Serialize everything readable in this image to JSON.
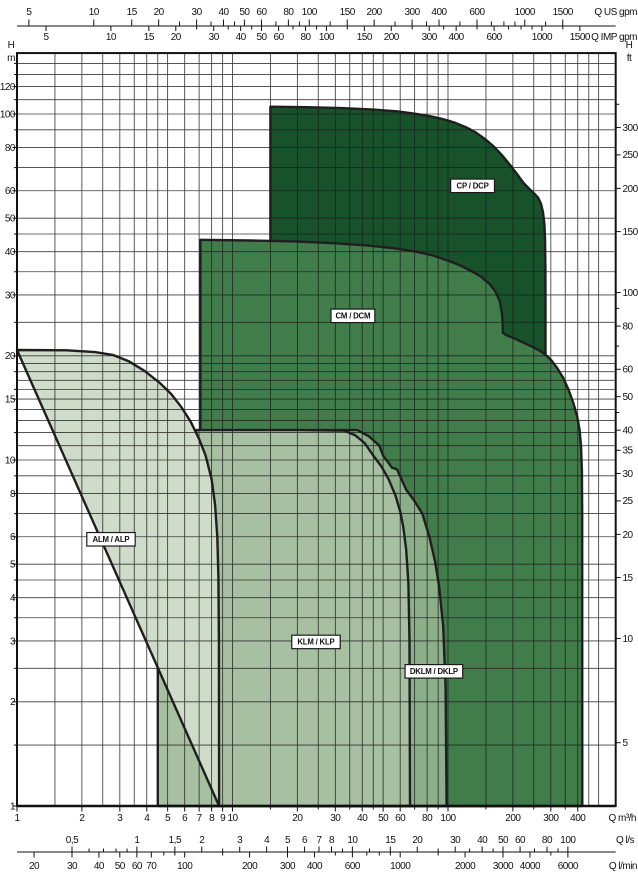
{
  "chart_data": {
    "type": "area",
    "title": "",
    "scale": {
      "x_type": "log",
      "y_type": "log",
      "q_min": 1,
      "q_max": 600,
      "q_unit": "m3/h",
      "h_min": 1,
      "h_max": 150,
      "h_unit": "m",
      "grid": "on"
    },
    "outline_color": "#1f1f1f",
    "grid_color": "#1c1c1c",
    "frame_color": "#111111",
    "x_axes": [
      {
        "id": "us-gpm",
        "unit_label": "Q US gpm",
        "factor_to_m3h": 0.22712,
        "row": "top1",
        "ticks": [
          [
            5,
            "5"
          ],
          [
            10,
            "10"
          ],
          [
            15,
            "15"
          ],
          [
            20,
            "20"
          ],
          [
            30,
            "30"
          ],
          [
            40,
            "40"
          ],
          [
            50,
            "50"
          ],
          [
            60,
            "60"
          ],
          [
            80,
            "80"
          ],
          [
            100,
            "100"
          ],
          [
            150,
            "150"
          ],
          [
            200,
            "200"
          ],
          [
            300,
            "300"
          ],
          [
            400,
            "400"
          ],
          [
            600,
            "600"
          ],
          [
            1000,
            "1000"
          ],
          [
            1500,
            "1500"
          ]
        ],
        "minor": [
          25,
          35,
          45,
          70,
          90,
          125,
          250,
          350,
          500,
          700,
          800,
          900,
          1250
        ]
      },
      {
        "id": "imp-gpm",
        "unit_label": "Q IMP gpm",
        "factor_to_m3h": 0.27276,
        "row": "top2",
        "ticks": [
          [
            5,
            "5"
          ],
          [
            10,
            "10"
          ],
          [
            15,
            "15"
          ],
          [
            20,
            "20"
          ],
          [
            30,
            "30"
          ],
          [
            40,
            "40"
          ],
          [
            50,
            "50"
          ],
          [
            60,
            "60"
          ],
          [
            80,
            "80"
          ],
          [
            100,
            "100"
          ],
          [
            150,
            "150"
          ],
          [
            200,
            "200"
          ],
          [
            300,
            "300"
          ],
          [
            400,
            "400"
          ],
          [
            600,
            "600"
          ],
          [
            1000,
            "1000"
          ],
          [
            1500,
            "1500"
          ]
        ],
        "minor": [
          25,
          35,
          45,
          70,
          90,
          125,
          250,
          350,
          500,
          700,
          800,
          900,
          1250
        ]
      },
      {
        "id": "m3h",
        "unit_label": "Q m³/h",
        "factor_to_m3h": 1,
        "row": "bottom1",
        "ticks": [
          [
            1,
            "1"
          ],
          [
            2,
            "2"
          ],
          [
            3,
            "3"
          ],
          [
            4,
            "4"
          ],
          [
            5,
            "5"
          ],
          [
            6,
            "6"
          ],
          [
            7,
            "7"
          ],
          [
            8,
            "8"
          ],
          [
            9,
            "9"
          ],
          [
            10,
            "10"
          ],
          [
            20,
            "20"
          ],
          [
            30,
            "30"
          ],
          [
            40,
            "40"
          ],
          [
            50,
            "50"
          ],
          [
            60,
            "60"
          ],
          [
            80,
            "80"
          ],
          [
            100,
            "100"
          ],
          [
            200,
            "200"
          ],
          [
            300,
            "300"
          ],
          [
            400,
            "400"
          ]
        ],
        "minor": [
          15,
          25,
          35,
          45,
          70,
          90,
          150,
          250,
          350
        ]
      },
      {
        "id": "ls",
        "unit_label": "Q l/s",
        "factor_to_m3h": 3.6,
        "row": "bottom2-above",
        "ticks": [
          [
            0.5,
            "0,5"
          ],
          [
            1,
            "1"
          ],
          [
            1.5,
            "1,5"
          ],
          [
            2,
            "2"
          ],
          [
            3,
            "3"
          ],
          [
            4,
            "4"
          ],
          [
            5,
            "5"
          ],
          [
            6,
            "6"
          ],
          [
            7,
            "7"
          ],
          [
            8,
            "8"
          ],
          [
            10,
            "10"
          ],
          [
            15,
            "15"
          ],
          [
            20,
            "20"
          ],
          [
            30,
            "30"
          ],
          [
            40,
            "40"
          ],
          [
            50,
            "50"
          ],
          [
            60,
            "60"
          ],
          [
            80,
            "80"
          ],
          [
            100,
            "100"
          ]
        ],
        "minor": [
          0.6,
          0.7,
          0.8,
          0.9,
          2.5,
          9,
          12,
          25,
          35,
          45,
          70,
          90
        ]
      },
      {
        "id": "lmin",
        "unit_label": "Q l/min",
        "factor_to_m3h": 0.06,
        "row": "bottom2-below",
        "ticks": [
          [
            20,
            "20"
          ],
          [
            30,
            "30"
          ],
          [
            40,
            "40"
          ],
          [
            50,
            "50"
          ],
          [
            60,
            "60"
          ],
          [
            70,
            "70"
          ],
          [
            100,
            "100"
          ],
          [
            200,
            "200"
          ],
          [
            300,
            "300"
          ],
          [
            400,
            "400"
          ],
          [
            600,
            "600"
          ],
          [
            1000,
            "1000"
          ],
          [
            2000,
            "2000"
          ],
          [
            3000,
            "3000"
          ],
          [
            4000,
            "4000"
          ],
          [
            6000,
            "6000"
          ]
        ],
        "minor": [
          80,
          90,
          150,
          500,
          700,
          800,
          900,
          1500,
          5000
        ]
      }
    ],
    "y_axes": [
      {
        "id": "h-m",
        "head": [
          "H",
          "m"
        ],
        "factor_to_m": 1,
        "side": "left",
        "ticks": [
          [
            1,
            "1"
          ],
          [
            2,
            "2"
          ],
          [
            3,
            "3"
          ],
          [
            4,
            "4"
          ],
          [
            5,
            "5"
          ],
          [
            6,
            "6"
          ],
          [
            8,
            "8"
          ],
          [
            10,
            "10"
          ],
          [
            15,
            "15"
          ],
          [
            20,
            "20"
          ],
          [
            30,
            "30"
          ],
          [
            40,
            "40"
          ],
          [
            50,
            "50"
          ],
          [
            60,
            "60"
          ],
          [
            80,
            "80"
          ],
          [
            100,
            "100"
          ],
          [
            120,
            "120"
          ]
        ],
        "minor": [
          1.5,
          2.5,
          3.5,
          4.5,
          7,
          9,
          12,
          14,
          16,
          18,
          25,
          35,
          45,
          70,
          90,
          110,
          130,
          140
        ]
      },
      {
        "id": "h-ft",
        "head": [
          "H",
          "ft"
        ],
        "factor_to_m": 0.3048,
        "side": "right",
        "ticks": [
          [
            5,
            "5"
          ],
          [
            10,
            "10"
          ],
          [
            15,
            "15"
          ],
          [
            20,
            "20"
          ],
          [
            25,
            "25"
          ],
          [
            30,
            "30"
          ],
          [
            35,
            "35"
          ],
          [
            40,
            "40"
          ],
          [
            50,
            "50"
          ],
          [
            60,
            "60"
          ],
          [
            80,
            "80"
          ],
          [
            100,
            "100"
          ],
          [
            150,
            "150"
          ],
          [
            200,
            "200"
          ],
          [
            250,
            "250"
          ],
          [
            300,
            "300"
          ]
        ],
        "minor": [
          45,
          70,
          90,
          350
        ]
      }
    ],
    "gridlines": {
      "q_values": [
        1.5,
        2,
        2.5,
        3,
        3.5,
        4,
        4.5,
        5,
        6,
        7,
        8,
        9,
        10,
        15,
        20,
        25,
        30,
        35,
        40,
        45,
        50,
        60,
        70,
        80,
        90,
        100,
        150,
        200,
        250,
        300,
        350,
        400,
        450,
        500
      ],
      "h_values": [
        1.5,
        2,
        2.5,
        3,
        3.5,
        4,
        4.5,
        5,
        6,
        7,
        8,
        9,
        10,
        11,
        12,
        13,
        14,
        15,
        16,
        17,
        18,
        19,
        20,
        25,
        30,
        35,
        40,
        45,
        50,
        60,
        70,
        80,
        90,
        100,
        110,
        120,
        130,
        140
      ]
    },
    "series": [
      {
        "name": "CP / DCP",
        "fill": "#17522b",
        "points": [
          [
            15,
            1
          ],
          [
            15,
            105
          ],
          [
            22,
            104.6
          ],
          [
            32,
            104
          ],
          [
            45,
            103
          ],
          [
            58,
            101.8
          ],
          [
            70,
            100.2
          ],
          [
            82,
            98.6
          ],
          [
            95,
            96.6
          ],
          [
            108,
            94.3
          ],
          [
            122,
            91.4
          ],
          [
            135,
            88.3
          ],
          [
            148,
            84.8
          ],
          [
            162,
            80.8
          ],
          [
            178,
            76
          ],
          [
            195,
            71
          ],
          [
            210,
            66.8
          ],
          [
            225,
            63
          ],
          [
            240,
            60.5
          ],
          [
            252,
            58.8
          ],
          [
            262,
            57.3
          ],
          [
            270,
            55
          ],
          [
            276,
            52
          ],
          [
            280,
            48
          ],
          [
            282,
            44
          ],
          [
            283,
            36
          ],
          [
            283.5,
            28
          ],
          [
            283.5,
            1
          ]
        ]
      },
      {
        "name": "CM / DCM",
        "fill": "#417c4b",
        "points": [
          [
            7.1,
            1
          ],
          [
            7.1,
            43.3
          ],
          [
            12,
            43.1
          ],
          [
            20,
            42.8
          ],
          [
            30,
            42.3
          ],
          [
            42,
            41.7
          ],
          [
            55,
            41
          ],
          [
            70,
            40.1
          ],
          [
            85,
            39
          ],
          [
            100,
            37.7
          ],
          [
            113,
            36.6
          ],
          [
            128,
            35.2
          ],
          [
            141,
            34
          ],
          [
            155,
            32.4
          ],
          [
            166,
            30.7
          ],
          [
            174,
            28.8
          ],
          [
            178,
            26.5
          ],
          [
            179.5,
            24.5
          ],
          [
            179.5,
            23.3
          ],
          [
            188,
            22.9
          ],
          [
            205,
            22.4
          ],
          [
            225,
            21.8
          ],
          [
            248,
            21.2
          ],
          [
            270,
            20.6
          ],
          [
            285,
            20.1
          ],
          [
            302,
            19.4
          ],
          [
            322,
            18.4
          ],
          [
            342,
            17.3
          ],
          [
            362,
            16
          ],
          [
            382,
            14.6
          ],
          [
            398,
            13.3
          ],
          [
            408,
            12.2
          ],
          [
            414,
            11
          ],
          [
            418,
            9.3
          ],
          [
            419.5,
            7
          ],
          [
            420,
            1
          ]
        ]
      },
      {
        "name": "DKLM / DKLP",
        "fill": "#8bb089",
        "points": [
          [
            20,
            1
          ],
          [
            20,
            12.2
          ],
          [
            38,
            12.2
          ],
          [
            43,
            11.7
          ],
          [
            48,
            11
          ],
          [
            50,
            10.3
          ],
          [
            55,
            9.5
          ],
          [
            58,
            9.4
          ],
          [
            64,
            8.2
          ],
          [
            70,
            7.6
          ],
          [
            76,
            7
          ],
          [
            82,
            6
          ],
          [
            87,
            5.1
          ],
          [
            91,
            4.3
          ],
          [
            95,
            3.3
          ],
          [
            97.5,
            2.2
          ],
          [
            98.5,
            1
          ]
        ]
      },
      {
        "name": "KLM / KLP",
        "fill": "#a6c0a1",
        "points": [
          [
            4.5,
            1
          ],
          [
            4.5,
            12.2
          ],
          [
            20,
            12.2
          ],
          [
            33,
            12.15
          ],
          [
            37,
            11.8
          ],
          [
            41,
            11.2
          ],
          [
            45,
            10.3
          ],
          [
            49,
            9.6
          ],
          [
            53,
            8.8
          ],
          [
            57,
            7.9
          ],
          [
            60,
            7.1
          ],
          [
            62,
            6.4
          ],
          [
            64,
            5.5
          ],
          [
            65.5,
            4.4
          ],
          [
            66.3,
            3
          ],
          [
            66.6,
            1
          ]
        ]
      },
      {
        "name": "ALM / ALP",
        "fill": "#cfdcca",
        "points": [
          [
            1,
            20.8
          ],
          [
            1.7,
            20.75
          ],
          [
            2.3,
            20.5
          ],
          [
            2.8,
            20.1
          ],
          [
            3.3,
            19.3
          ],
          [
            3.9,
            18.1
          ],
          [
            4.6,
            16.7
          ],
          [
            5.2,
            15.5
          ],
          [
            5.8,
            14.2
          ],
          [
            6.4,
            12.9
          ],
          [
            7,
            11.5
          ],
          [
            7.5,
            10.3
          ],
          [
            8,
            8.8
          ],
          [
            8.3,
            7.4
          ],
          [
            8.5,
            6
          ],
          [
            8.6,
            4.6
          ],
          [
            8.65,
            3
          ],
          [
            8.67,
            1
          ]
        ]
      }
    ],
    "region_labels": [
      {
        "text": "ALM / ALP",
        "q": 2.73,
        "h": 5.9
      },
      {
        "text": "KLM / KLP",
        "q": 24.4,
        "h": 2.98
      },
      {
        "text": "DKLM / DKLP",
        "q": 86,
        "h": 2.45
      },
      {
        "text": "CM / DCM",
        "q": 36.2,
        "h": 26.1
      },
      {
        "text": "CP / DCP",
        "q": 130,
        "h": 62
      }
    ]
  }
}
